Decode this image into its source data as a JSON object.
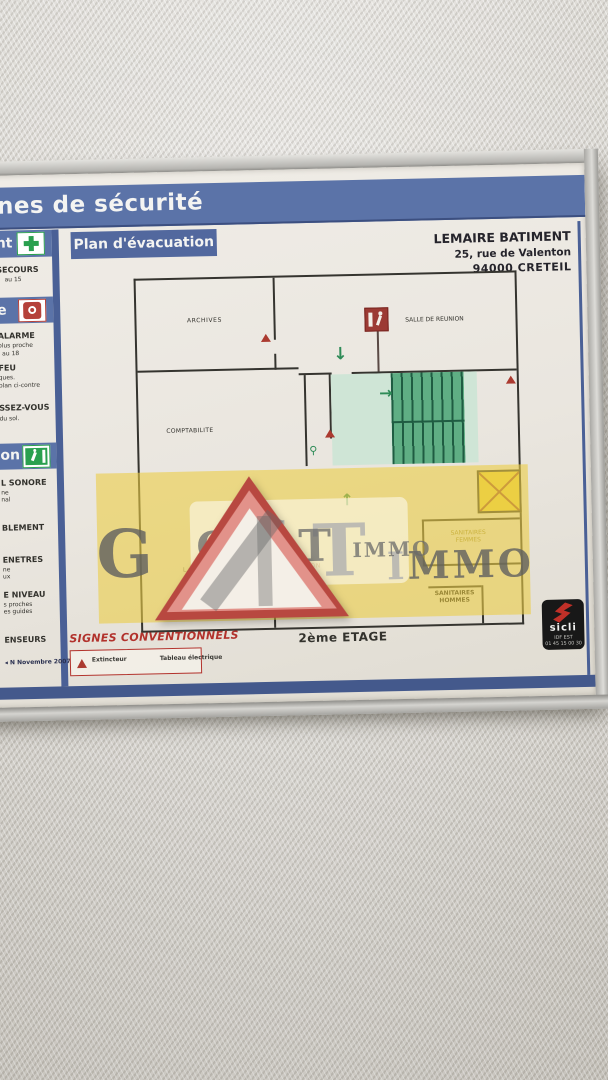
{
  "header": {
    "title_fragment": "nes de sécurité"
  },
  "plan_banner": {
    "label": "Plan d'évacuation"
  },
  "building": {
    "name": "LEMAIRE BATIMENT",
    "address": "25, rue de Valenton",
    "city": "94000  CRETEIL"
  },
  "sidebar": {
    "band1_fragment": "nt",
    "s1_line1": "SECOURS",
    "s1_line2": "au 15",
    "band2_fragment": "e",
    "s2_line1": "ALARME",
    "s2_line2": "plus proche",
    "s2_line3": "au 18",
    "s3_line1": "FEU",
    "s3_line2": "ques.",
    "s3_line3": "plan ci-contre",
    "s4_line1": "SSEZ-VOUS",
    "s4_line2": "du sol.",
    "band3_fragment": "on",
    "s5_line1": "L SONORE",
    "s5_line2": "ne",
    "s5_line3": "nal",
    "s6_line1": "BLEMENT",
    "s7_line1": "ENETRES",
    "s7_line2": "ne",
    "s7_line3": "ux",
    "s8_line1": "E NIVEAU",
    "s8_line2": "s proches",
    "s8_line3": "es guides",
    "s9_line1": "ENSEURS",
    "edition": "N Novembre 2007"
  },
  "floorplan": {
    "rooms": {
      "archives": "ARCHIVES",
      "salle_de_reunion": "SALLE DE REUNION",
      "comptabilite": "COMPTABILITE",
      "sanitaires_femmes_l1": "SANITAIRES",
      "sanitaires_femmes_l2": "FEMMES",
      "sanitaires_hommes_l1": "SANITAIRES",
      "sanitaires_hommes_l2": "HOMMES",
      "obscured_fragment": "TATION",
      "tiny_fragment": "L.a.s"
    },
    "floor_label": "2ème ETAGE"
  },
  "legend": {
    "title": "SIGNES CONVENTIONNELS",
    "item1": "Extincteur",
    "item2": "Tableau électrique"
  },
  "watermark": {
    "g": "G",
    "h": "H",
    "t": "T",
    "immo": "IMMO"
  },
  "sicli": {
    "brand": "sicli",
    "line1": "IDF EST",
    "line2": "01 45 15 00 30"
  },
  "icons": {
    "arrow_down": "↓",
    "arrow_right": "→",
    "arrow_up": "↑",
    "edition_marker": "◂"
  },
  "colors": {
    "band_blue": "#5b73a8",
    "stripe_blue": "#4a6096",
    "cream": "#ebe7e0",
    "stair_green": "#5fae84",
    "corridor_green": "#cfe5d6",
    "watermark_yellow": "#ecd468",
    "triangle_red": "#b84840",
    "safety_green": "#2aa04f",
    "alert_red": "#b5413a"
  }
}
